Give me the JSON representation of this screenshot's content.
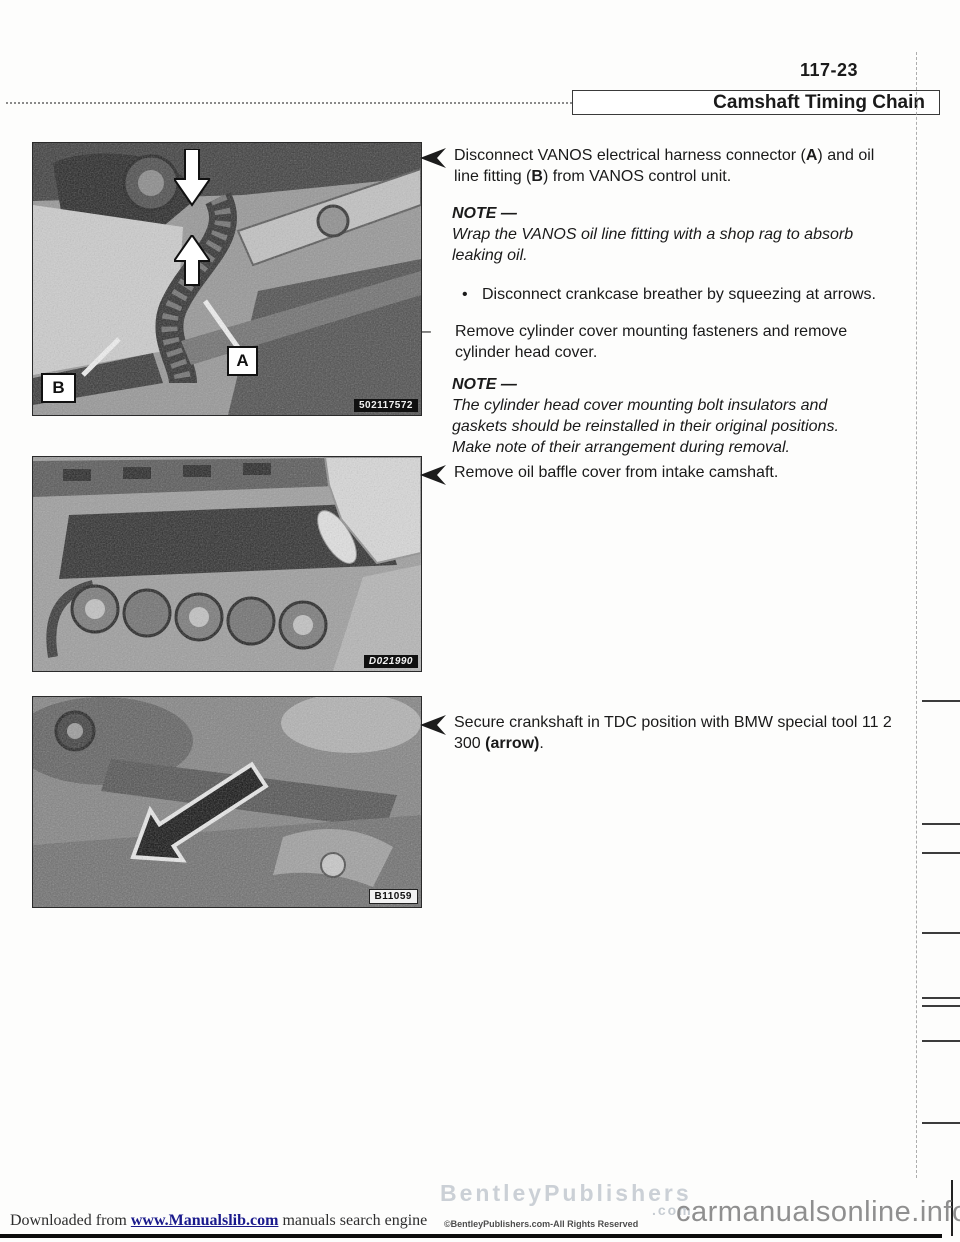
{
  "page": {
    "number": "117-23",
    "title": "Camshaft Timing Chain"
  },
  "photos": {
    "photo1": {
      "label_a": "A",
      "label_b": "B",
      "id_tag": "502117572"
    },
    "photo2": {
      "id_tag": "D021990"
    },
    "photo3": {
      "id_tag": "B11059"
    }
  },
  "steps": {
    "step1": {
      "seg1": "Disconnect VANOS electrical harness connector (",
      "bold1": "A",
      "seg2": ") and oil line fitting (",
      "bold2": "B",
      "seg3": ") from VANOS control unit."
    },
    "note1": {
      "label": "NOTE —",
      "body": "Wrap the VANOS oil line fitting with a shop rag to absorb leaking oil."
    },
    "bullet1": {
      "marker": "•",
      "text": "Disconnect crankcase breather by squeezing at arrows."
    },
    "dash1": {
      "marker": "–",
      "text": "Remove cylinder cover mounting fasteners and remove cylinder head cover."
    },
    "note2": {
      "label": "NOTE —",
      "body": "The cylinder head cover mounting bolt insulators and gaskets should be reinstalled in their original positions. Make note of their arrangement during removal."
    },
    "step2": {
      "text": "Remove oil baffle cover from intake camshaft."
    },
    "step3": {
      "seg1": "Secure crankshaft in TDC position with BMW special tool 11 2 300 ",
      "bold1": "(arrow)",
      "seg2": "."
    }
  },
  "footer": {
    "downloaded_pre": "Downloaded from ",
    "downloaded_link": "www.Manualslib.com",
    "downloaded_post": " manuals search engine",
    "watermark_line1": "BentleyPublishers",
    "watermark_line2": ".com",
    "copyright": "©BentleyPublishers.com-All Rights Reserved",
    "site": "carmanualsonline.info"
  },
  "colors": {
    "page_bg": "#fdfdfc",
    "ink": "#1a1a1a",
    "watermark_gray": "#c6ccd2",
    "site_gray": "#8f8f8f"
  }
}
